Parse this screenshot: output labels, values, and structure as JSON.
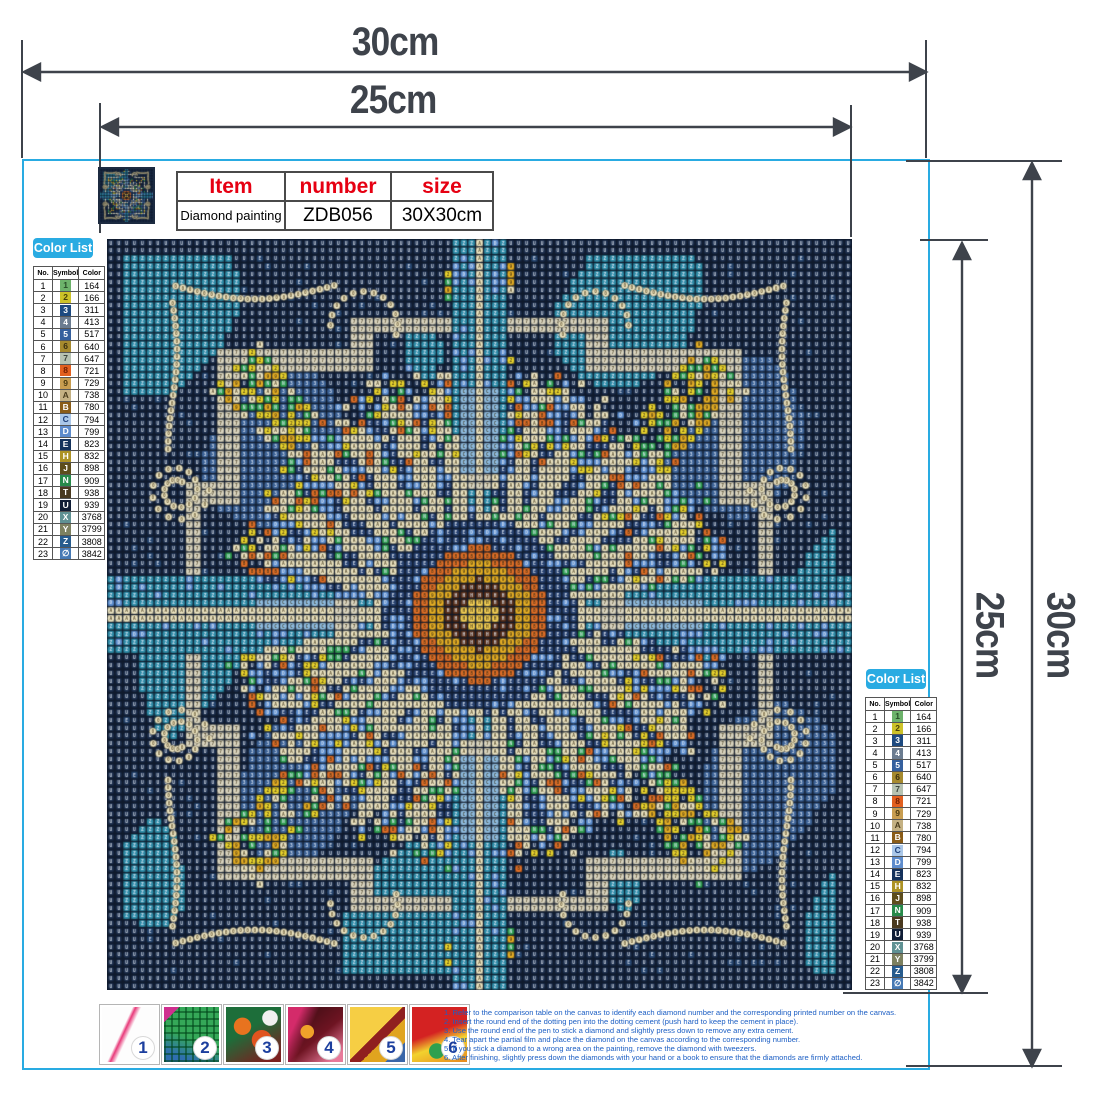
{
  "accent": "#29abe2",
  "dimensions": {
    "top_outer": "30cm",
    "top_inner": "25cm",
    "right_inner": "25cm",
    "right_outer": "30cm"
  },
  "product_table": {
    "headers": [
      "Item",
      "number",
      "size"
    ],
    "values": [
      "Diamond painting",
      "ZDB056",
      "30X30cm"
    ],
    "header_color": "#e60012"
  },
  "color_list": {
    "title": "Color List",
    "columns": [
      "No.",
      "Symbol",
      "Color"
    ],
    "rows": [
      {
        "no": "1",
        "symbol": "1",
        "code": "164",
        "chip": "#6db36b",
        "tc": "#274d27"
      },
      {
        "no": "2",
        "symbol": "2",
        "code": "166",
        "chip": "#cdc228",
        "tc": "#4a4208"
      },
      {
        "no": "3",
        "symbol": "3",
        "code": "311",
        "chip": "#1d4a80",
        "tc": "#ffffff"
      },
      {
        "no": "4",
        "symbol": "4",
        "code": "413",
        "chip": "#6b7c90",
        "tc": "#ffffff"
      },
      {
        "no": "5",
        "symbol": "5",
        "code": "517",
        "chip": "#35609e",
        "tc": "#ffffff"
      },
      {
        "no": "6",
        "symbol": "6",
        "code": "640",
        "chip": "#a68a2e",
        "tc": "#3a2f10"
      },
      {
        "no": "7",
        "symbol": "7",
        "code": "647",
        "chip": "#b7c3b2",
        "tc": "#3c463c"
      },
      {
        "no": "8",
        "symbol": "8",
        "code": "721",
        "chip": "#e2601f",
        "tc": "#701d00"
      },
      {
        "no": "9",
        "symbol": "9",
        "code": "729",
        "chip": "#c89d50",
        "tc": "#4a3a10"
      },
      {
        "no": "10",
        "symbol": "A",
        "code": "738",
        "chip": "#c4b183",
        "tc": "#4a3d1d"
      },
      {
        "no": "11",
        "symbol": "B",
        "code": "780",
        "chip": "#8a5c17",
        "tc": "#ffffff"
      },
      {
        "no": "12",
        "symbol": "C",
        "code": "794",
        "chip": "#aac7e8",
        "tc": "#1d3f7a"
      },
      {
        "no": "13",
        "symbol": "D",
        "code": "799",
        "chip": "#5e8ccc",
        "tc": "#ffffff"
      },
      {
        "no": "14",
        "symbol": "E",
        "code": "823",
        "chip": "#14325c",
        "tc": "#ffffff"
      },
      {
        "no": "15",
        "symbol": "H",
        "code": "832",
        "chip": "#ad9224",
        "tc": "#ffffff"
      },
      {
        "no": "16",
        "symbol": "J",
        "code": "898",
        "chip": "#5d4d1c",
        "tc": "#ffffff"
      },
      {
        "no": "17",
        "symbol": "N",
        "code": "909",
        "chip": "#27894a",
        "tc": "#ffffff"
      },
      {
        "no": "18",
        "symbol": "T",
        "code": "938",
        "chip": "#4a3a1f",
        "tc": "#ffffff"
      },
      {
        "no": "19",
        "symbol": "U",
        "code": "939",
        "chip": "#101d36",
        "tc": "#ffffff"
      },
      {
        "no": "20",
        "symbol": "X",
        "code": "3768",
        "chip": "#5f9193",
        "tc": "#ffffff"
      },
      {
        "no": "21",
        "symbol": "Y",
        "code": "3799",
        "chip": "#7d8160",
        "tc": "#ffffff"
      },
      {
        "no": "22",
        "symbol": "Z",
        "code": "3808",
        "chip": "#275c8e",
        "tc": "#ffffff"
      },
      {
        "no": "23",
        "symbol": "∅",
        "code": "3842",
        "chip": "#4679b4",
        "tc": "#ffffff"
      }
    ]
  },
  "steps": [
    "1",
    "2",
    "3",
    "4",
    "5",
    "6"
  ],
  "instructions": [
    "1.  Refer  to  the  comparison  table  on  the  canvas  to  identify  each  diamond  number  and  the  corresponding  printed  number  on  the  canvas.",
    "2.  Insert  the  round  end  of  the  dotting  pen  into  the  dotting  cement  (push  hard  to  keep  the  cement  in  place).",
    "3.  Use  the  round  end  of  the  pen  to  stick  a  diamond  and  slightly  press  down  to  remove  any  extra  cement.",
    "4.  Tear  apart  the  partial  film  and  place  the  diamond  on  the  canvas  according  to  the  corresponding  number.",
    "5.  If  you  stick  a  diamond  to  a  wrong  area  on  the  painting,  remove  the  diamond  with  tweezers.",
    "6.  After  finishing,  slightly  press  down  the  diamonds  with  your  hand  or  a  book  to  ensure  that  the  diamonds  are  firmly  attached."
  ],
  "canvas_art": {
    "grid_cols": 95,
    "palette": {
      "navy": "#1b2d4b",
      "navy2": "#25446e",
      "teal": "#2e8ca8",
      "midblue": "#3c6296",
      "lightblue": "#8fbce0",
      "cream": "#ece4c2",
      "frame": "#d9d4bf",
      "gold": "#e6af25",
      "gold_center": "#f3cf55",
      "orange": "#e06f28",
      "darkring": "#58301c",
      "yellow": "#e9d42e",
      "green": "#2f9e52",
      "blue": "#5a8ccd",
      "navyring": "#26406e"
    }
  }
}
